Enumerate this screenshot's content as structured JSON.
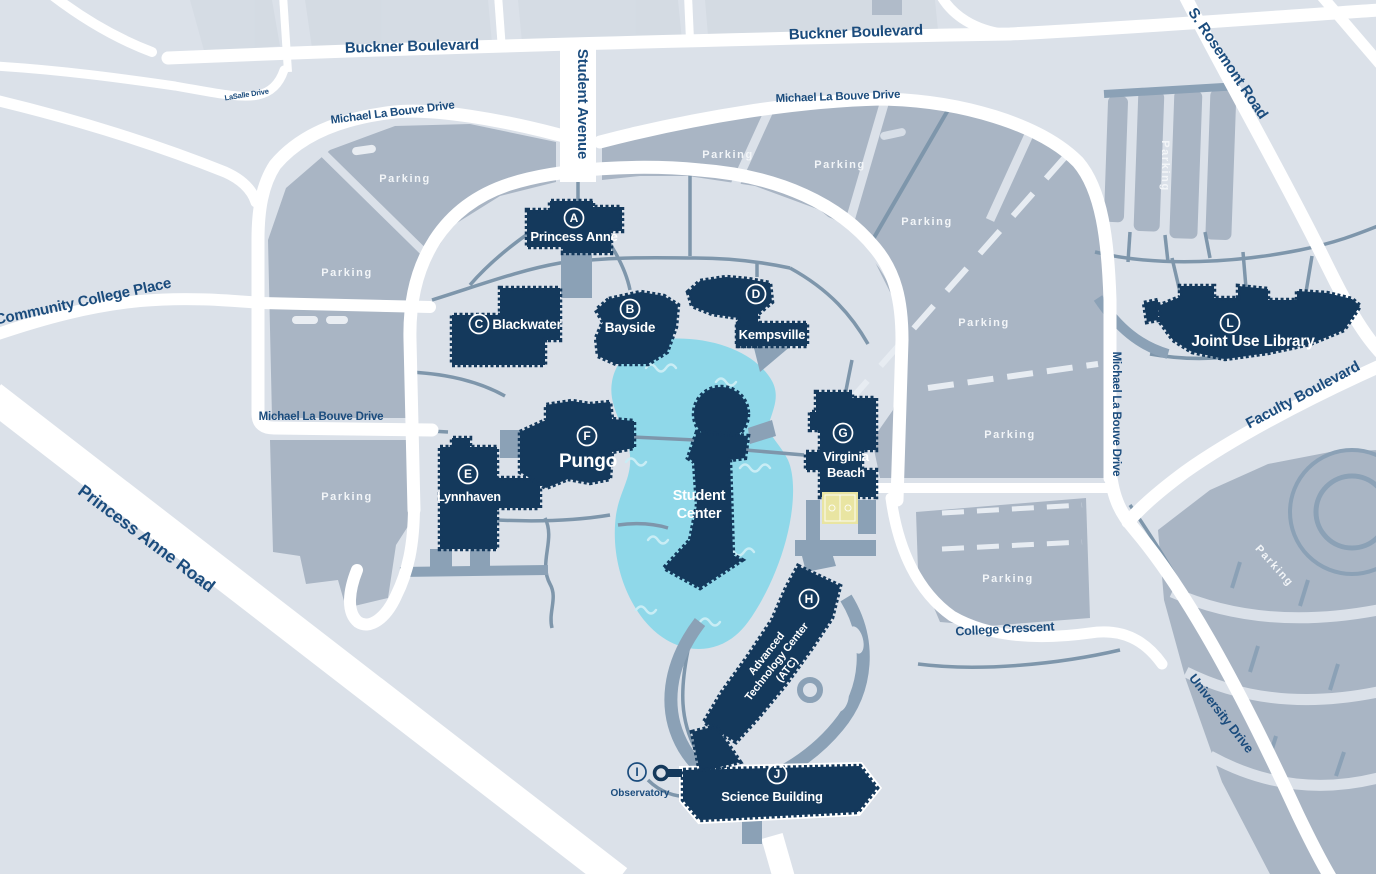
{
  "colors": {
    "bg": "#dbe1e9",
    "parking": "#a9b5c4",
    "building": "#14395c",
    "pond": "#8fd8e9",
    "court": "#e9e5a2",
    "roadlabel": "#1b4c7d"
  },
  "roads": {
    "buckner_boulevard": "Buckner Boulevard",
    "student_avenue": "Student Avenue",
    "michael_la_bouve_drive": "Michael La Bouve Drive",
    "s_rosemont_road": "S. Rosemont Road",
    "lasalle_drive": "LaSalle Drive",
    "community_college_place": "Community College Place",
    "princess_anne_road": "Princess Anne Road",
    "faculty_boulevard": "Faculty Boulevard",
    "college_crescent": "College Crescent",
    "university_drive": "University Drive"
  },
  "parking_label": "Parking",
  "buildings": {
    "princess_anne": {
      "letter": "A",
      "name": "Princess Anne"
    },
    "bayside": {
      "letter": "B",
      "name": "Bayside"
    },
    "blackwater": {
      "letter": "C",
      "name": "Blackwater"
    },
    "kempsville": {
      "letter": "D",
      "name": "Kempsville"
    },
    "lynnhaven": {
      "letter": "E",
      "name": "Lynnhaven"
    },
    "pungo": {
      "letter": "F",
      "name": "Pungo"
    },
    "virginia_beach": {
      "letter": "G",
      "line1": "Virginia",
      "line2": "Beach"
    },
    "advanced_technology_center": {
      "letter": "H",
      "line1": "Advanced",
      "line2": "Technology Center",
      "line3": "(ATC)"
    },
    "observatory": {
      "letter": "I",
      "name": "Observatory"
    },
    "science_building": {
      "letter": "J",
      "name": "Science Building"
    },
    "joint_use_library": {
      "letter": "L",
      "name": "Joint Use Library"
    },
    "student_center": {
      "line1": "Student",
      "line2": "Center"
    }
  }
}
